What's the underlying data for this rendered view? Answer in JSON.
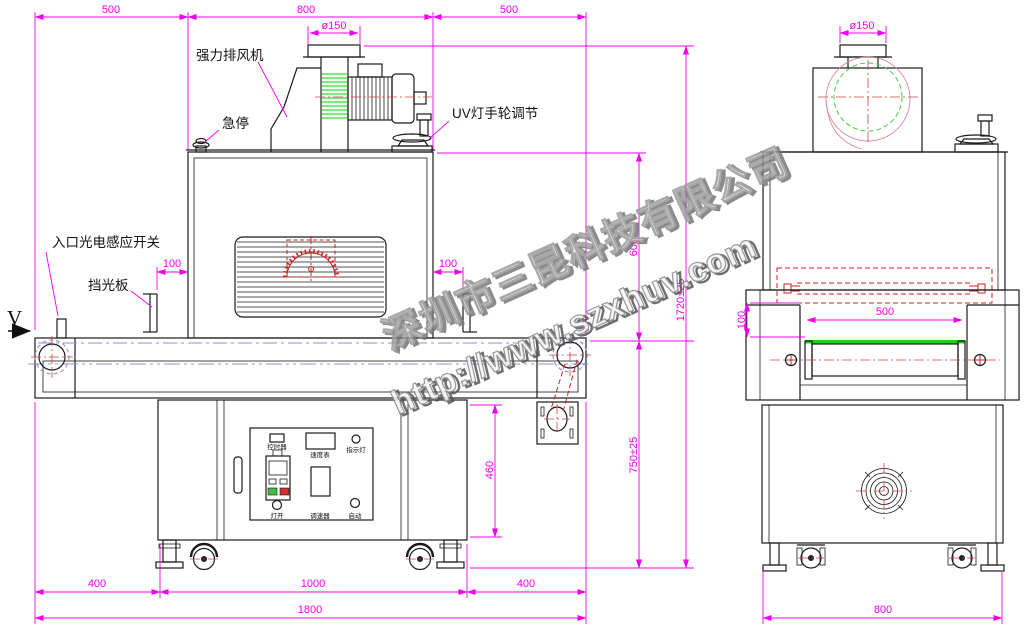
{
  "drawing": {
    "direction_marker": "V",
    "callouts": {
      "exhaust_fan": "强力排风机",
      "emergency_stop": "急停",
      "uv_handwheel": "UV灯手轮调节",
      "entry_sensor": "入口光电感应开关",
      "light_baffle": "挡光板"
    },
    "control_panel": {
      "timer": "控时器",
      "speed_meter": "速度表",
      "indicator": "指示灯",
      "lamp_on": "灯开",
      "speed_ctrl": "调速器",
      "start": "启动"
    },
    "dims": {
      "top_left": "500",
      "top_mid": "800",
      "top_right": "500",
      "flange_front": "ø150",
      "flange_side": "ø150",
      "baffle_left": "100",
      "baffle_right": "100",
      "oven_height": "600",
      "total_height": "1720±25",
      "belt_height": "750±25",
      "cabinet_height": "460",
      "foot_left": "400",
      "cabinet_width": "1000",
      "foot_right": "400",
      "total_length": "1800",
      "lamp_gap": "100",
      "belt_width": "500",
      "side_width": "800"
    },
    "watermark": {
      "company": "深圳市三昆科技有限公司",
      "url": "http://www.szxhuv.com"
    },
    "colors": {
      "dimension": "#ee00ee",
      "line": "#1a1a1a",
      "red_detail": "#cc2222",
      "green_detail": "#33cc33",
      "belt_guide": "#9090c8",
      "fan_inlet_green": "#7fe87f",
      "watermark_gray": "#9a9a9a"
    }
  }
}
